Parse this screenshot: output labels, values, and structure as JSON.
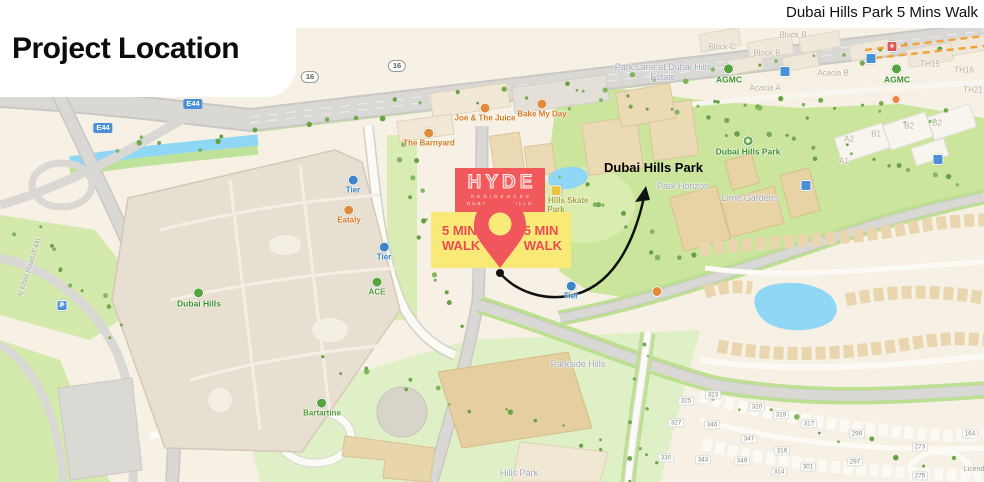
{
  "header": {
    "title": "Project Location",
    "caption": "Dubai Hills Park 5 Mins Walk"
  },
  "callout": {
    "park": "Dubai Hills Park"
  },
  "logo": {
    "name": "HYDE",
    "sub": "RESIDENCES",
    "city": "DUBAI",
    "area": "HILLS"
  },
  "walk": {
    "left_line1": "5 MIN",
    "left_line2": "WALK",
    "right_line1": "5 MIN",
    "right_line2": "WALK"
  },
  "colors": {
    "accent_red": "#F1595B",
    "accent_yellow": "#F9EA77",
    "path_black": "#111111",
    "park_green": "#CBE59D",
    "water_blue": "#8FD7F5",
    "road_gray": "#D9D8D5",
    "building_tan": "#EBDAB4",
    "label_green": "#3E8F2F",
    "label_orange": "#D4781F",
    "label_blue": "#2E7FC2"
  },
  "map_labels": [
    {
      "name": "road-badge-16",
      "cls": "badge-white",
      "x": 310,
      "y": 77,
      "lines": [
        "16"
      ]
    },
    {
      "name": "road-badge-16",
      "cls": "badge-white",
      "x": 397,
      "y": 66,
      "lines": [
        "16"
      ]
    },
    {
      "name": "road-badge-e44",
      "cls": "badge-blue",
      "x": 193,
      "y": 104,
      "lines": [
        "E44"
      ]
    },
    {
      "name": "road-badge-e44",
      "cls": "badge-blue",
      "x": 103,
      "y": 128,
      "lines": [
        "E44"
      ]
    },
    {
      "name": "poi-tier",
      "cls": "poi-blue",
      "icon": "scooter-icon",
      "x": 353,
      "y": 185,
      "lines": [
        "Tier"
      ]
    },
    {
      "name": "poi-eataly",
      "cls": "poi-orange",
      "icon": "restaurant-icon",
      "x": 349,
      "y": 215,
      "lines": [
        "Eataly"
      ]
    },
    {
      "name": "poi-tier",
      "cls": "poi-blue",
      "icon": "scooter-icon",
      "x": 384,
      "y": 252,
      "lines": [
        "Tier"
      ]
    },
    {
      "name": "poi-ace",
      "cls": "poi-green",
      "icon": "store-icon",
      "x": 377,
      "y": 287,
      "lines": [
        "ACE"
      ]
    },
    {
      "name": "poi-the-barnyard",
      "cls": "poi-orange",
      "icon": "restaurant-icon",
      "x": 429,
      "y": 138,
      "lines": [
        "The Barnyard"
      ]
    },
    {
      "name": "poi-joe-and-the-juice",
      "cls": "poi-orange",
      "icon": "cafe-icon",
      "x": 485,
      "y": 113,
      "lines": [
        "Joe & The Juice"
      ]
    },
    {
      "name": "poi-bake-my-day",
      "cls": "poi-orange",
      "icon": "cafe-icon",
      "x": 542,
      "y": 109,
      "lines": [
        "Bake My Day"
      ]
    },
    {
      "name": "poi-skate-park",
      "cls": "poi-olive",
      "icon": "skate-icon",
      "x": 556,
      "y": 200,
      "lines": [
        "Dubai Hills Skate",
        "Park"
      ]
    },
    {
      "name": "plot-label",
      "cls": "gray",
      "x": 549,
      "y": 264,
      "lines": [
        "SS 48631"
      ]
    },
    {
      "name": "poi-tier",
      "cls": "poi-blue",
      "icon": "scooter-icon",
      "x": 571,
      "y": 291,
      "lines": [
        "Tier"
      ]
    },
    {
      "name": "poi-dubai-hills-mall",
      "cls": "big-green",
      "icon": "store-icon",
      "x": 199,
      "y": 298,
      "lines": [
        "Dubai Hills"
      ]
    },
    {
      "name": "poi-bartartine",
      "cls": "poi-green",
      "icon": "store-icon",
      "x": 322,
      "y": 408,
      "lines": [
        "Bartartine"
      ]
    },
    {
      "name": "district-park-lane",
      "cls": "district",
      "x": 663,
      "y": 73,
      "lines": [
        "Park Lane at Dubai Hills",
        "Estate"
      ]
    },
    {
      "name": "block-label",
      "cls": "area",
      "x": 722,
      "y": 48,
      "lines": [
        "Block C"
      ]
    },
    {
      "name": "block-label",
      "cls": "area",
      "x": 793,
      "y": 36,
      "lines": [
        "Block B"
      ]
    },
    {
      "name": "block-label",
      "cls": "area",
      "x": 767,
      "y": 54,
      "lines": [
        "Block B"
      ]
    },
    {
      "name": "poi-agmc",
      "cls": "big-green",
      "icon": "dealer-icon",
      "x": 729,
      "y": 74,
      "lines": [
        "AGMC"
      ]
    },
    {
      "name": "block-label",
      "cls": "area",
      "x": 765,
      "y": 89,
      "lines": [
        "Acacia A"
      ]
    },
    {
      "name": "block-label",
      "cls": "area",
      "x": 833,
      "y": 74,
      "lines": [
        "Acacia B"
      ]
    },
    {
      "name": "poi-agmc",
      "cls": "big-green",
      "icon": "dealer-icon",
      "x": 897,
      "y": 74,
      "lines": [
        "AGMC"
      ]
    },
    {
      "name": "block-label",
      "cls": "area",
      "x": 930,
      "y": 65,
      "lines": [
        "TH15"
      ]
    },
    {
      "name": "block-label",
      "cls": "area",
      "x": 964,
      "y": 71,
      "lines": [
        "TH16"
      ]
    },
    {
      "name": "block-label",
      "cls": "area",
      "x": 973,
      "y": 91,
      "lines": [
        "TH21"
      ]
    },
    {
      "name": "block-label",
      "cls": "area",
      "x": 876,
      "y": 135,
      "lines": [
        "B1"
      ]
    },
    {
      "name": "block-label",
      "cls": "area",
      "x": 849,
      "y": 140,
      "lines": [
        "A2"
      ]
    },
    {
      "name": "block-label",
      "cls": "area",
      "x": 844,
      "y": 162,
      "lines": [
        "A1"
      ]
    },
    {
      "name": "block-label",
      "cls": "area",
      "x": 909,
      "y": 127,
      "lines": [
        "B2"
      ]
    },
    {
      "name": "block-label",
      "cls": "area",
      "x": 937,
      "y": 124,
      "lines": [
        "B2"
      ]
    },
    {
      "name": "poi-dubai-hills-park",
      "cls": "big-green",
      "icon": "tree-icon",
      "glyph": "♣",
      "x": 748,
      "y": 146,
      "lines": [
        "Dubai Hills Park"
      ]
    },
    {
      "name": "district-park-horizon",
      "cls": "district",
      "x": 683,
      "y": 187,
      "lines": [
        "Park Horizon"
      ]
    },
    {
      "name": "district-lime-gardens",
      "cls": "district",
      "x": 750,
      "y": 199,
      "lines": [
        "Lime Gardens"
      ]
    },
    {
      "name": "district-parkside-hills",
      "cls": "district",
      "x": 578,
      "y": 365,
      "lines": [
        "Parkside Hills"
      ]
    },
    {
      "name": "district-hills-park",
      "cls": "district",
      "x": 519,
      "y": 474,
      "lines": [
        "Hills Park"
      ]
    },
    {
      "name": "house-number",
      "cls": "housenum",
      "x": 713,
      "y": 395,
      "lines": [
        "323"
      ]
    },
    {
      "name": "house-number",
      "cls": "housenum",
      "x": 686,
      "y": 401,
      "lines": [
        "325"
      ]
    },
    {
      "name": "house-number",
      "cls": "housenum",
      "x": 676,
      "y": 423,
      "lines": [
        "327"
      ]
    },
    {
      "name": "house-number",
      "cls": "housenum",
      "x": 666,
      "y": 458,
      "lines": [
        "330"
      ]
    },
    {
      "name": "house-number",
      "cls": "housenum",
      "x": 757,
      "y": 407,
      "lines": [
        "320"
      ]
    },
    {
      "name": "house-number",
      "cls": "housenum",
      "x": 781,
      "y": 415,
      "lines": [
        "319"
      ]
    },
    {
      "name": "house-number",
      "cls": "housenum",
      "x": 809,
      "y": 424,
      "lines": [
        "317"
      ]
    },
    {
      "name": "house-number",
      "cls": "housenum",
      "x": 712,
      "y": 425,
      "lines": [
        "346"
      ]
    },
    {
      "name": "house-number",
      "cls": "housenum",
      "x": 749,
      "y": 439,
      "lines": [
        "347"
      ]
    },
    {
      "name": "house-number",
      "cls": "housenum",
      "x": 703,
      "y": 460,
      "lines": [
        "343"
      ]
    },
    {
      "name": "house-number",
      "cls": "housenum",
      "x": 742,
      "y": 461,
      "lines": [
        "349"
      ]
    },
    {
      "name": "house-number",
      "cls": "housenum",
      "x": 782,
      "y": 451,
      "lines": [
        "316"
      ]
    },
    {
      "name": "house-number",
      "cls": "housenum",
      "x": 779,
      "y": 472,
      "lines": [
        "314"
      ]
    },
    {
      "name": "house-number",
      "cls": "housenum",
      "x": 808,
      "y": 467,
      "lines": [
        "301"
      ]
    },
    {
      "name": "house-number",
      "cls": "housenum",
      "x": 857,
      "y": 434,
      "lines": [
        "299"
      ]
    },
    {
      "name": "house-number",
      "cls": "housenum",
      "x": 855,
      "y": 462,
      "lines": [
        "297"
      ]
    },
    {
      "name": "house-number",
      "cls": "housenum",
      "x": 920,
      "y": 447,
      "lines": [
        "273"
      ]
    },
    {
      "name": "house-number",
      "cls": "housenum",
      "x": 920,
      "y": 476,
      "lines": [
        "275"
      ]
    },
    {
      "name": "house-number",
      "cls": "housenum",
      "x": 970,
      "y": 434,
      "lines": [
        "164"
      ]
    },
    {
      "name": "partial-label",
      "cls": "gray",
      "x": 974,
      "y": 470,
      "lines": [
        "Licend"
      ]
    },
    {
      "name": "street-name-label",
      "cls": "gray",
      "rot": -72,
      "x": 30,
      "y": 268,
      "lines": [
        "Al Khail Road (E44)"
      ]
    },
    {
      "name": "transit-stop",
      "icon": "transit-icon",
      "x": 785,
      "y": 72,
      "lines": []
    },
    {
      "name": "transit-stop",
      "icon": "transit-icon",
      "x": 871,
      "y": 59,
      "lines": []
    },
    {
      "name": "transit-stop",
      "icon": "transit-icon",
      "x": 806,
      "y": 186,
      "lines": []
    },
    {
      "name": "transit-stop",
      "icon": "transit-icon",
      "x": 938,
      "y": 160,
      "lines": []
    },
    {
      "name": "parking-poi",
      "icon": "parking-icon",
      "glyph": "P",
      "x": 62,
      "y": 306,
      "lines": []
    },
    {
      "name": "hospital-poi",
      "icon": "hospital-icon",
      "glyph": "+",
      "x": 892,
      "y": 47,
      "lines": []
    },
    {
      "name": "poi-dot",
      "icon": "dot-icon",
      "x": 896,
      "y": 100,
      "lines": []
    },
    {
      "name": "cafe-poi",
      "icon": "cafe-icon",
      "x": 657,
      "y": 292,
      "lines": []
    }
  ]
}
